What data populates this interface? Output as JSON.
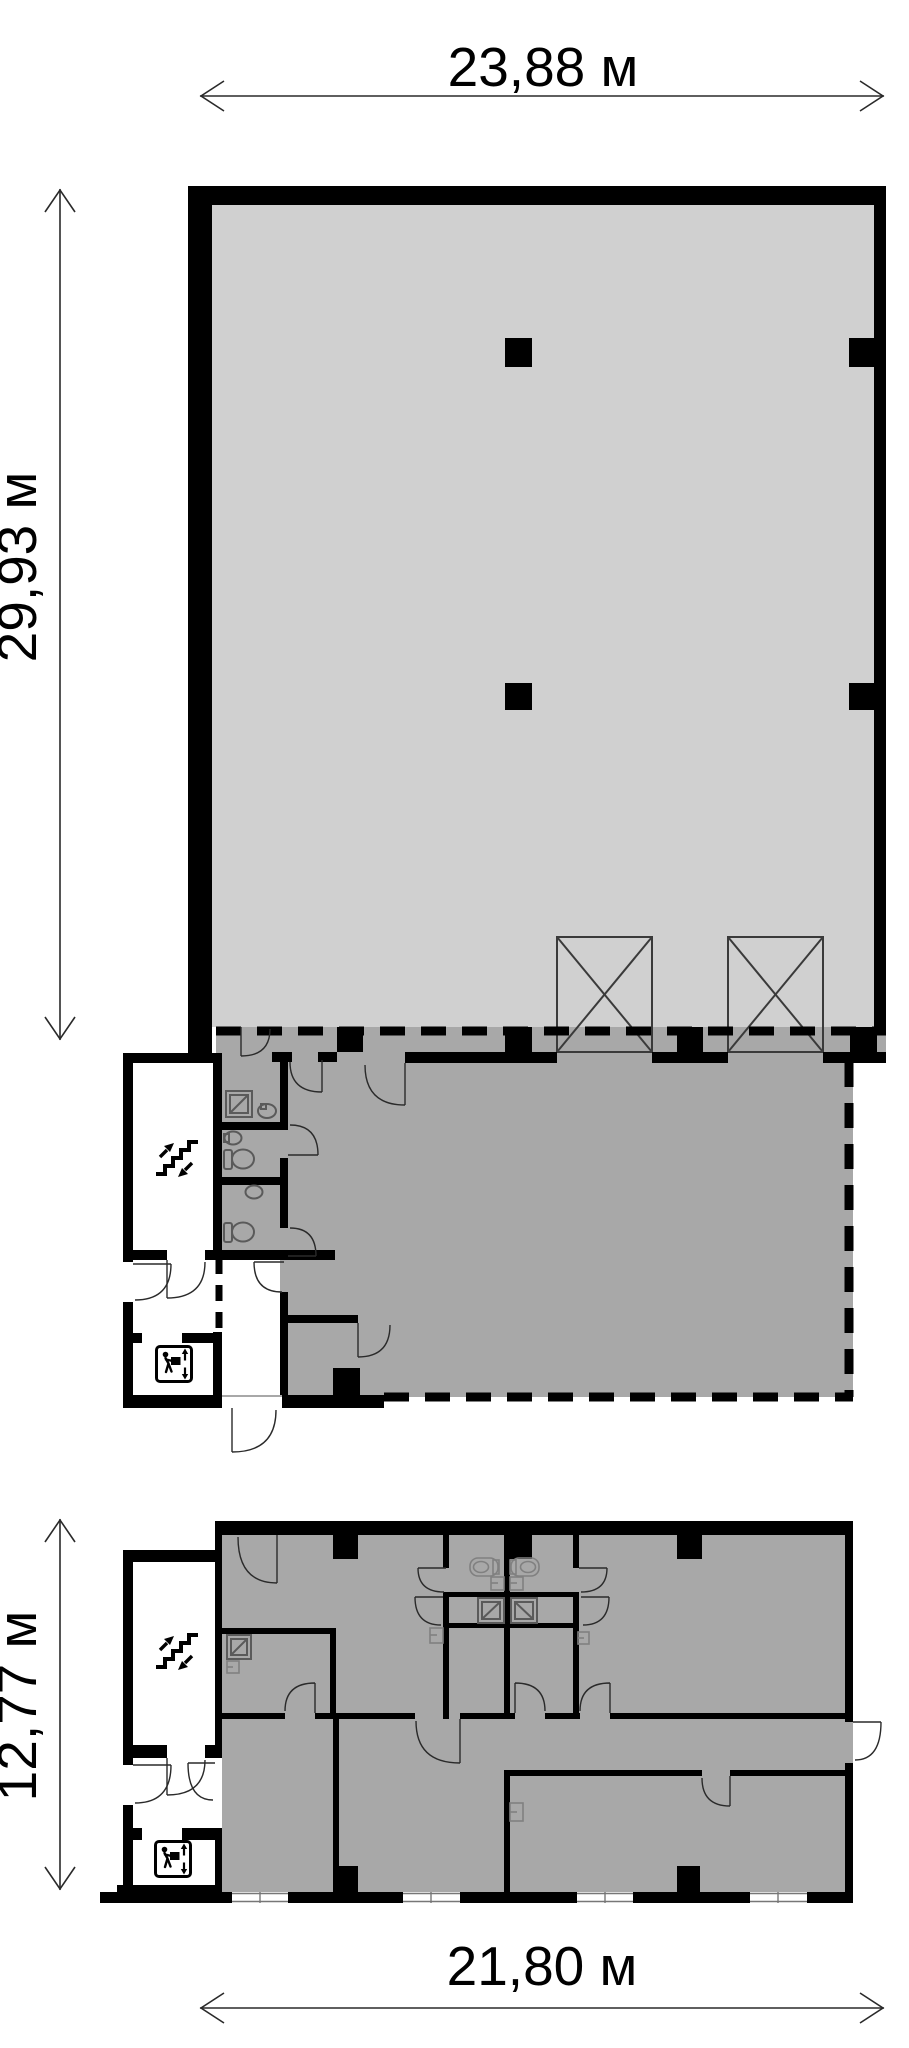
{
  "colors": {
    "wall": "#000000",
    "light": "#d0d0d0",
    "mid": "#a8a8a8",
    "thin": "#2a2a2a",
    "fixture": "#5a5a5a",
    "frame": "#808080",
    "bg": "#ffffff"
  },
  "dimensions": {
    "top": "23,88 м",
    "left_upper": "29,93 м",
    "left_lower": "12,77 м",
    "bottom": "21,80 м"
  },
  "icons": {
    "stairs_icon": "zigzag-steps-with-up-down-arrows",
    "freight_elevator_icon": "person-with-box-and-up-down-arrows",
    "elevator_shaft_icon": "square-with-diagonal-cross"
  }
}
